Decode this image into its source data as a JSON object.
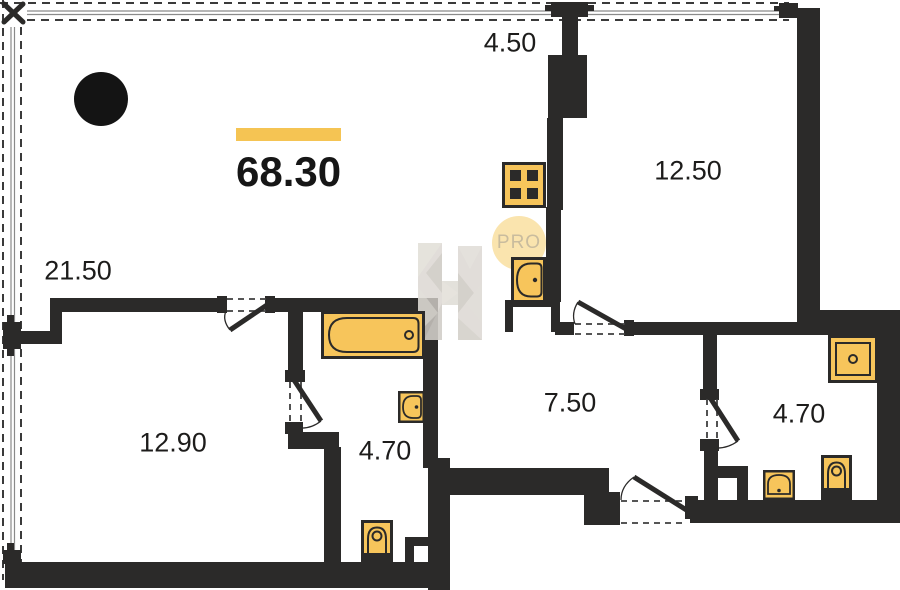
{
  "plan": {
    "total": {
      "area": "68.30"
    },
    "rooms": {
      "balcony": {
        "area": "4.50"
      },
      "living": {
        "area": "21.50"
      },
      "bedroom": {
        "area": "12.50"
      },
      "room2": {
        "area": "12.90"
      },
      "hallway": {
        "area": "7.50"
      },
      "bathroom_left": {
        "area": "4.70"
      },
      "bathroom_right": {
        "area": "4.70"
      }
    },
    "watermarks": {
      "badge": "PRO",
      "logo_letter": "H"
    },
    "icons": {
      "marker": "black-circle-marker",
      "kitchen": [
        "stove-icon",
        "sink-icon"
      ],
      "bathroom_left": [
        "bathtub-icon",
        "sink-icon",
        "toilet-icon"
      ],
      "bathroom_right": [
        "shower-icon",
        "sink-icon",
        "toilet-icon"
      ]
    },
    "colors": {
      "wall": "#2b2a29",
      "fixture_fill": "#f7c55b",
      "accent_bar": "#f5c453",
      "badge_fill": "#fae4ae",
      "badge_text": "#c9bc9e",
      "watermark_gray": "#d8d4ce"
    }
  }
}
